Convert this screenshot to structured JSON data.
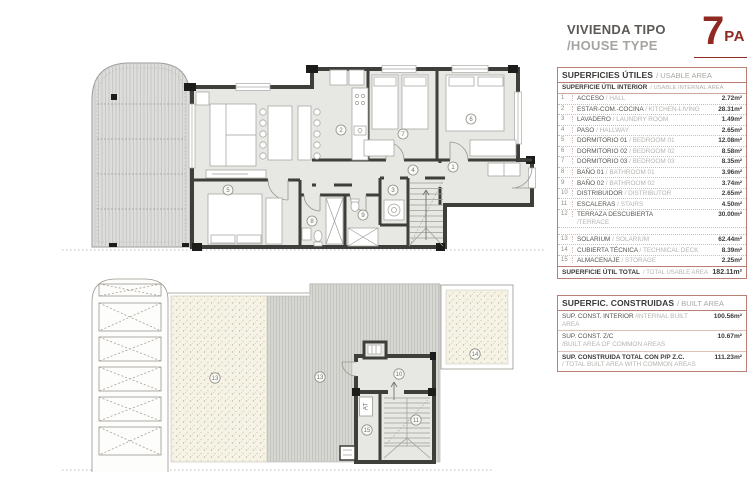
{
  "header": {
    "title_line1": "VIVIENDA TIPO",
    "title_line2": "/HOUSE TYPE",
    "unit_number": "7",
    "unit_code": "PA"
  },
  "usable_table": {
    "title": "SUPERFICIES ÚTILES",
    "title_en": "/ USABLE AREA",
    "subtitle": "SUPERFICIE ÚTIL INTERIOR",
    "subtitle_en": "/ USABLE INTERNAL AREA",
    "rows": [
      {
        "n": "1",
        "es": "ACCESO",
        "en": "/ HALL",
        "v": "2.72m²"
      },
      {
        "n": "2",
        "es": "ESTAR-COM.-COCINA",
        "en": "/ KITCHEN-LIVING",
        "v": "28.31m²"
      },
      {
        "n": "3",
        "es": "LAVADERO",
        "en": "/ LAUNDRY ROOM",
        "v": "1.49m²"
      },
      {
        "n": "4",
        "es": "PASO",
        "en": "/ HALLWAY",
        "v": "2.65m²"
      },
      {
        "n": "5",
        "es": "DORMITORIO 01",
        "en": "/ BEDROOM 01",
        "v": "12.08m²"
      },
      {
        "n": "6",
        "es": "DORMITORIO 02",
        "en": "/ BEDROOM 02",
        "v": "8.58m²"
      },
      {
        "n": "7",
        "es": "DORMITORIO 03",
        "en": "/ BEDROOM 03",
        "v": "8.35m²"
      },
      {
        "n": "8",
        "es": "BAÑO 01",
        "en": "/ BATHROOM 01",
        "v": "3.96m²"
      },
      {
        "n": "9",
        "es": "BAÑO 02",
        "en": "/ BATHROOM 02",
        "v": "3.74m²"
      },
      {
        "n": "10",
        "es": "DISTRIBUIDOR",
        "en": "/ DISTRIBUTOR",
        "v": "2.65m²"
      },
      {
        "n": "11",
        "es": "ESCALERAS",
        "en": "/ STAIRS",
        "v": "4.50m²"
      },
      {
        "n": "12",
        "es": "TERRAZA DESCUBIERTA",
        "en": "/TERRACE",
        "v": "30.00m²",
        "wrap": true
      },
      {
        "n": "13",
        "es": "SOLARIUM",
        "en": "/ SOLARIUM",
        "v": "62.44m²",
        "gap": true
      },
      {
        "n": "14",
        "es": "CUBIERTA TÉCNICA",
        "en": "/ TECHNICAL DECK",
        "v": "8.39m²"
      },
      {
        "n": "15",
        "es": "ALMACENAJE",
        "en": "/ STORAGE",
        "v": "2.25m²"
      }
    ],
    "total_label": "SUPERFICIE ÚTIL TOTAL",
    "total_label_en": "/ TOTAL USABLE AREA",
    "total_value": "182.11m²"
  },
  "built_table": {
    "title": "SUPERFIC. CONSTRUIDAS",
    "title_en": "/ BUILT AREA",
    "rows": [
      {
        "es": "SUP. CONST. INTERIOR",
        "en": "/INTERNAL BUILT AREA",
        "v": "100.56m²"
      },
      {
        "es": "SUP. CONST. Z/C",
        "en": "/BUILT AREA OF COMMON AREAS",
        "v": "10.67m²",
        "wrap": true
      },
      {
        "es": "SUP. CONSTRUIDA TOTAL CON P/P Z.C.",
        "en": "/ TOTAL BUILT AREA WITH COMMON AREAS",
        "v": "111.23m²",
        "wrap": true,
        "strong": true
      }
    ]
  },
  "plans": {
    "main": {
      "labels": [
        {
          "n": "2"
        },
        {
          "n": "7"
        },
        {
          "n": "6"
        },
        {
          "n": "1"
        },
        {
          "n": "4"
        },
        {
          "n": "3"
        },
        {
          "n": "9"
        },
        {
          "n": "8"
        },
        {
          "n": "5"
        }
      ]
    },
    "roof": {
      "labels": [
        {
          "n": "13"
        },
        {
          "n": "13"
        },
        {
          "n": "10"
        },
        {
          "n": "11"
        },
        {
          "n": "14"
        },
        {
          "n": "15"
        }
      ],
      "attic_label": "AT"
    }
  },
  "colors": {
    "accent": "#8e2a22",
    "wall": "#3e3e3b",
    "table_border": "#b87f72"
  }
}
